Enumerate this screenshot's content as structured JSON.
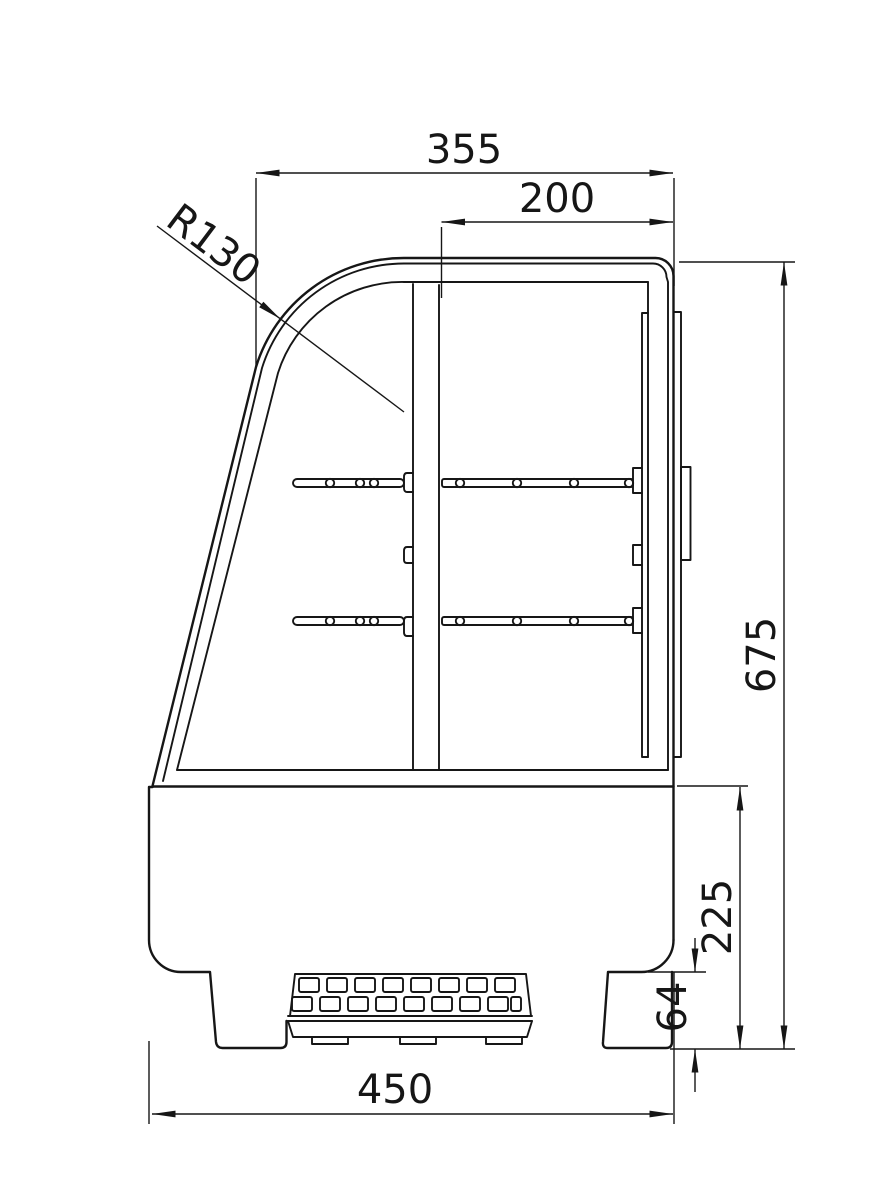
{
  "dimensions": {
    "top_width": "355",
    "top_inner_width": "200",
    "front_glass_radius": "R130",
    "overall_height": "675",
    "lower_body_height": "225",
    "foot_height": "64",
    "bottom_width": "450"
  },
  "colors": {
    "line": "#161616",
    "background": "#ffffff"
  }
}
